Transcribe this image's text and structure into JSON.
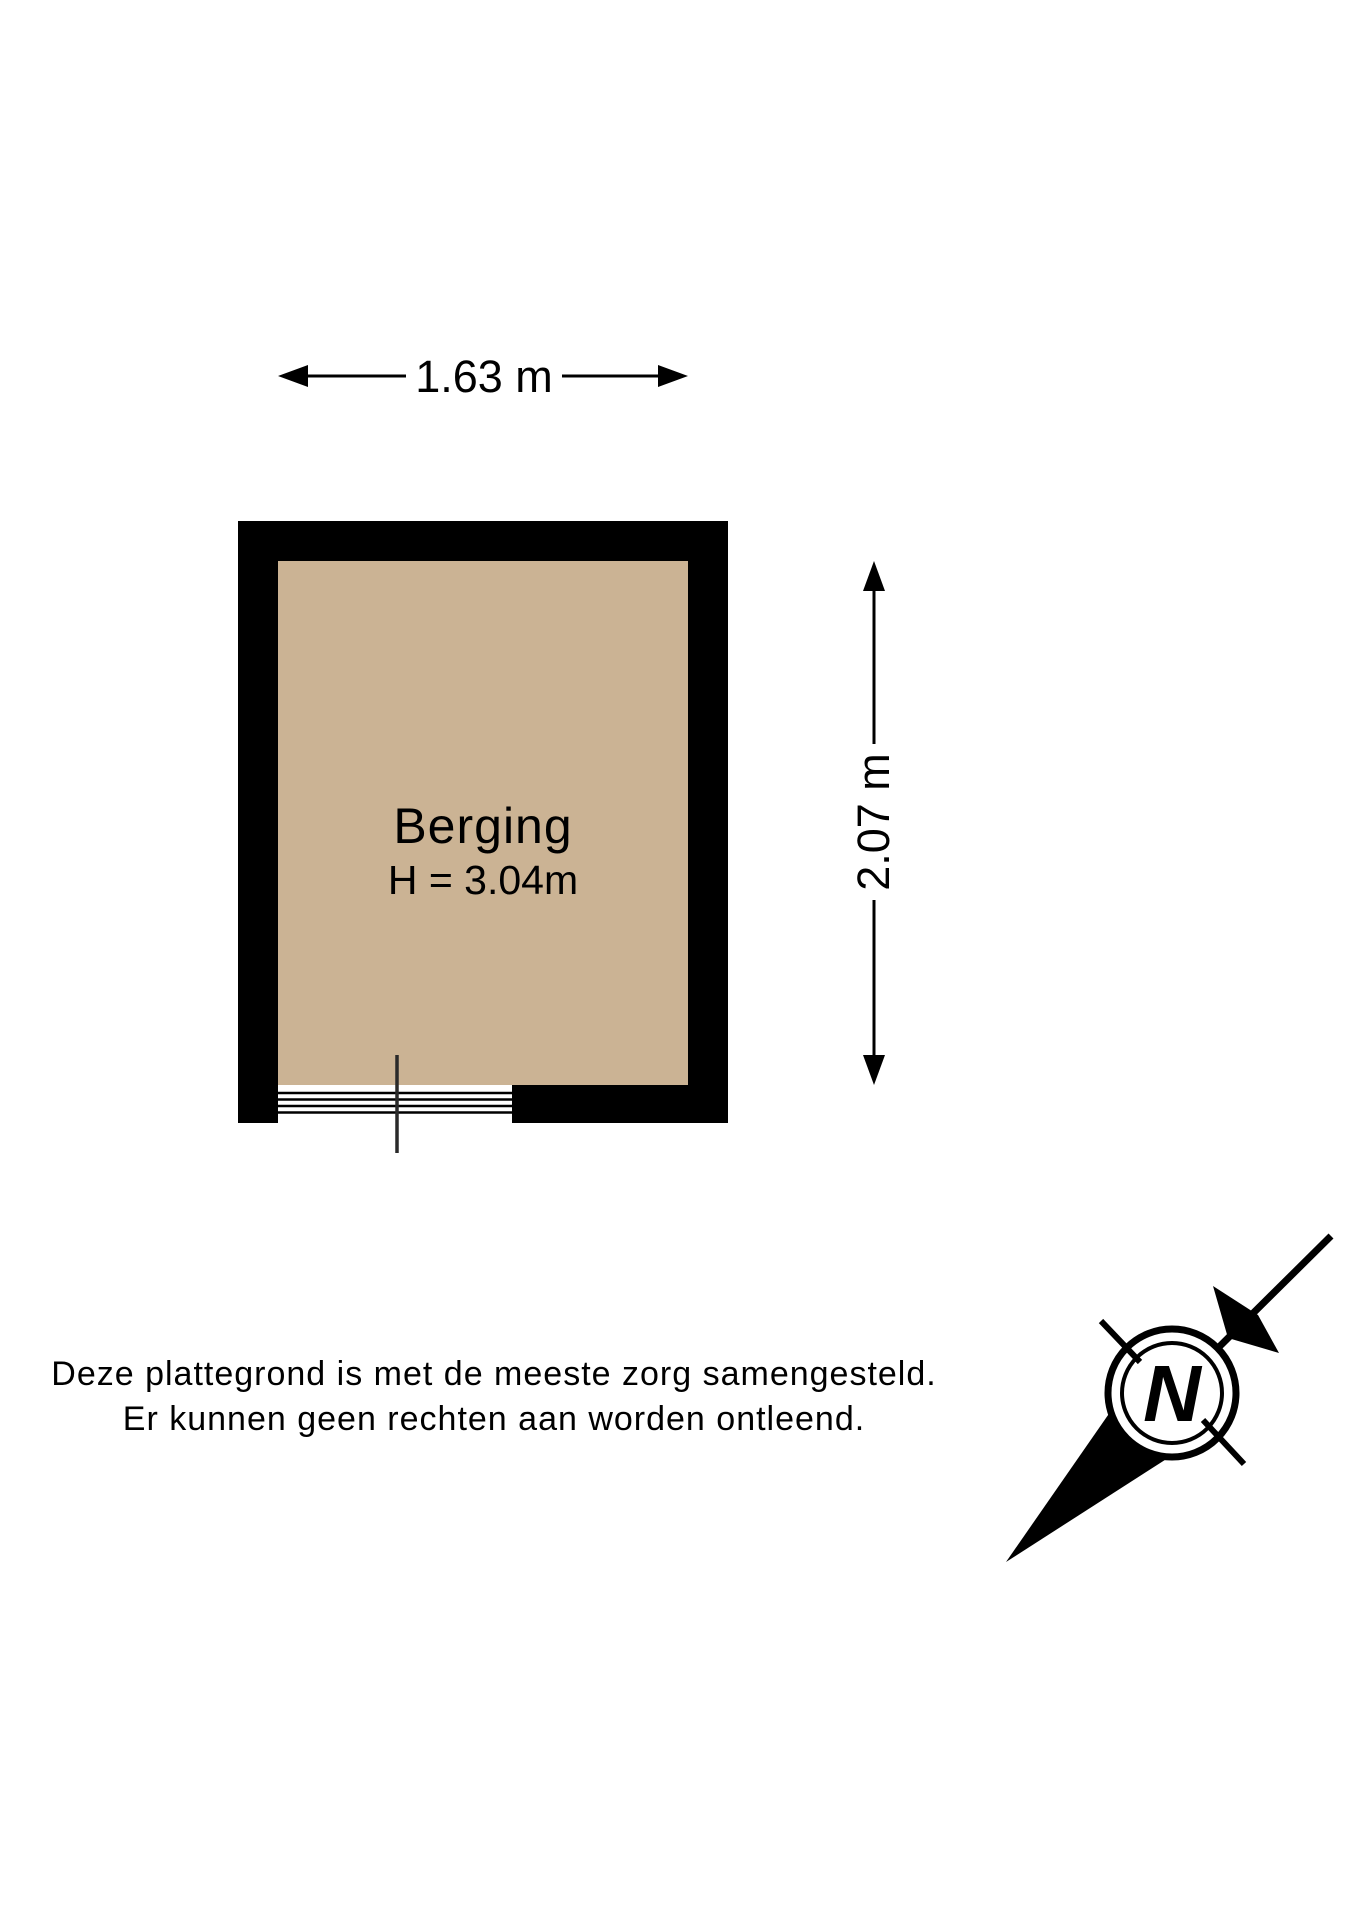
{
  "floorplan": {
    "room": {
      "label": "Berging",
      "ceiling_height_label": "H = 3.04m"
    },
    "dimensions": {
      "width_label": "1.63 m",
      "height_label": "2.07 m"
    },
    "colors": {
      "floor": "#cbb394",
      "wall": "#000000",
      "line": "#000000"
    }
  },
  "compass": {
    "north_label": "N"
  },
  "disclaimer": {
    "line1": "Deze plattegrond is met de meeste zorg samengesteld.",
    "line2": "Er kunnen geen rechten aan worden ontleend."
  }
}
